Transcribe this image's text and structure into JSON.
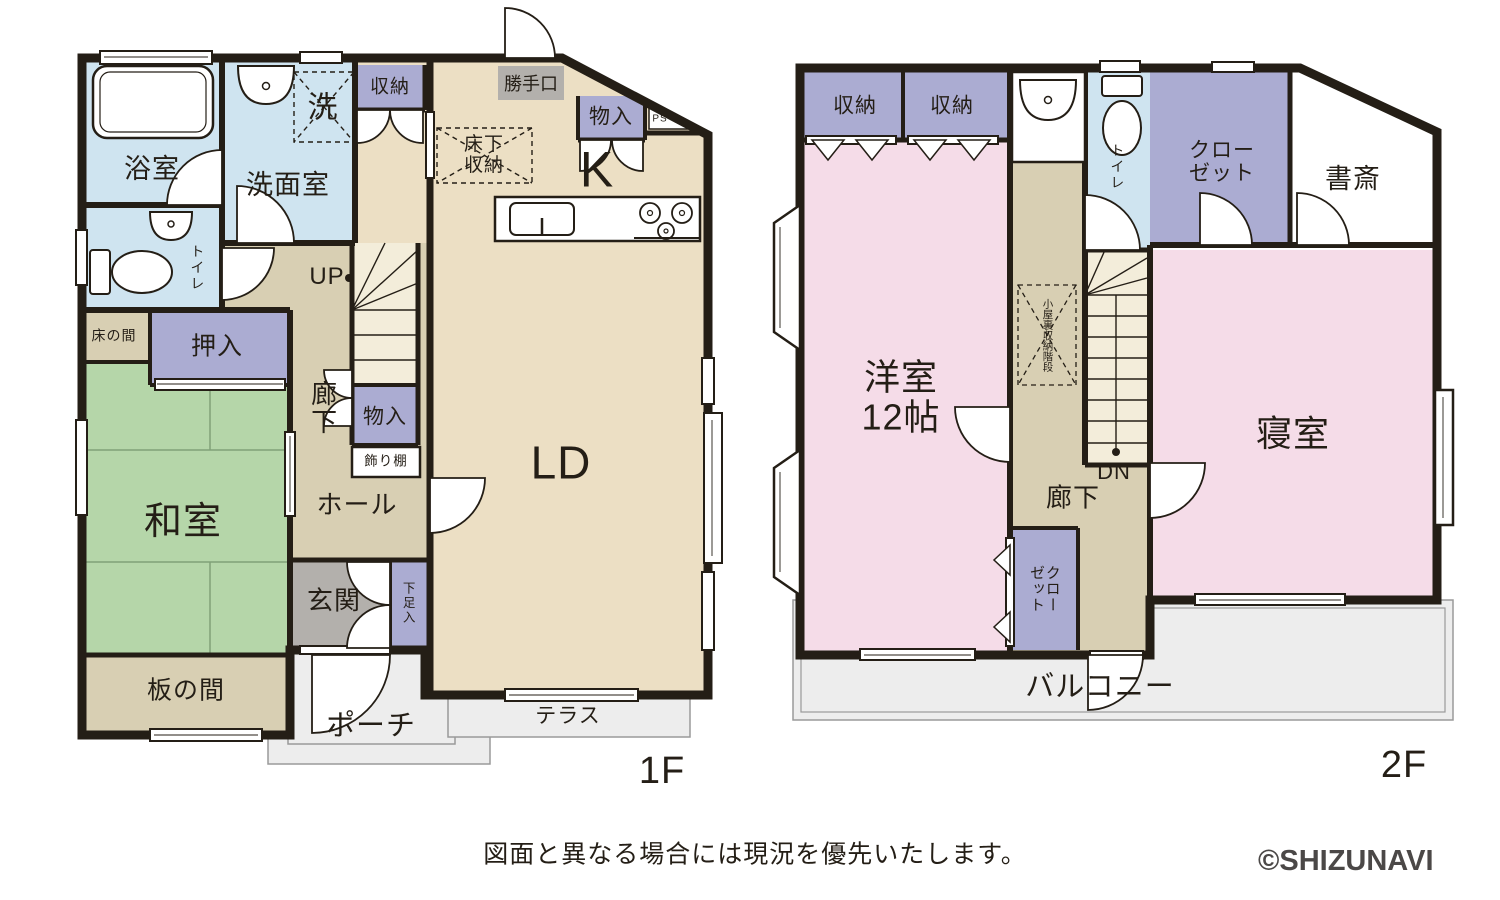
{
  "f1": {
    "floor_label": "1F",
    "bath": "浴室",
    "washroom": "洗面室",
    "laundry": "洗",
    "storage": "収納",
    "backdoor": "勝手口",
    "closet_tr": "物入",
    "ps": "PS",
    "underfloor": "床下\n収納",
    "kitchen": "K",
    "toilet": "トイレ",
    "up": "UP",
    "tokonoma": "床の間",
    "oshiire": "押入",
    "corridor": "廊下",
    "closet_stairs": "物入",
    "shelf": "飾り棚",
    "washitsu": "和室",
    "hall": "ホール",
    "living": "LD",
    "entrance": "玄関",
    "shoebox": "下足入",
    "itanoma": "板の間",
    "porch": "ポーチ",
    "terrace": "テラス"
  },
  "f2": {
    "floor_label": "2F",
    "storage_a": "収納",
    "storage_b": "収納",
    "toilet": "トイレ",
    "closet_tr": "クロー\nゼット",
    "study": "書斎",
    "western": "洋室\n12帖",
    "attic": "小屋裏収納階段",
    "dn": "DN",
    "bedroom": "寝室",
    "corridor": "廊下",
    "closet_b": "クローゼット",
    "balcony": "バルコニー"
  },
  "footer": {
    "disclaimer": "図面と異なる場合には現況を優先いたします。",
    "copyright": "©SHIZUNAVI"
  },
  "colors": {
    "wall": "#241e16",
    "water_blue": "#cfe4f0",
    "storage_purple": "#abacd2",
    "wood_light": "#ecdfc4",
    "wood_dark": "#d8cfb3",
    "tatami_green": "#b5d6a9",
    "pink": "#f5dce8",
    "stairs_cream": "#f3edda",
    "entrance_gray": "#b3b0ac",
    "outdoor_gray": "#ededed"
  }
}
